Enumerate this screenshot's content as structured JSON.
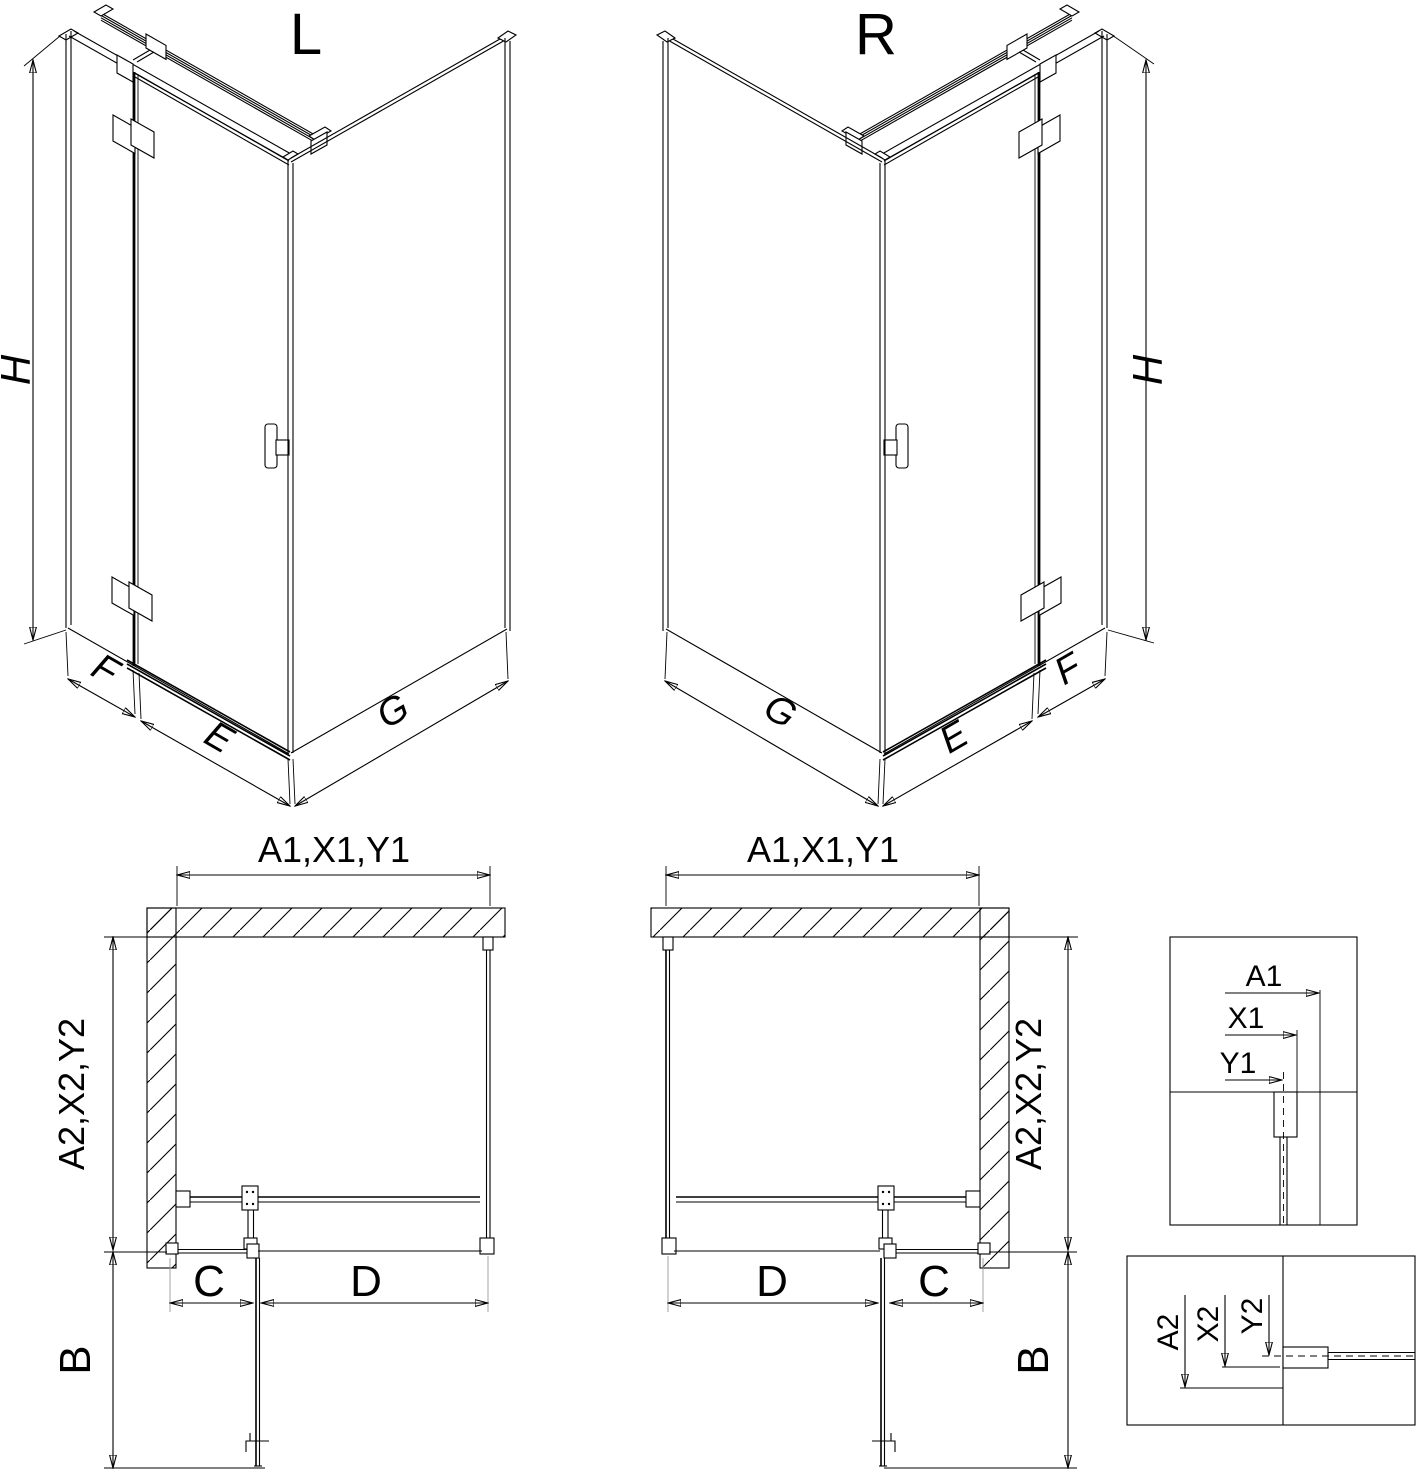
{
  "iso_left": {
    "title": "L",
    "dim_height": "H",
    "dim_side_width": "F",
    "dim_door_width": "E",
    "dim_return_width": "G"
  },
  "iso_right": {
    "title": "R",
    "dim_height": "H",
    "dim_side_width": "F",
    "dim_door_width": "E",
    "dim_return_width": "G"
  },
  "plan_left": {
    "dim_width": "A1,X1,Y1",
    "dim_depth": "A2,X2,Y2",
    "dim_fixed": "C",
    "dim_door": "D",
    "dim_door_open": "B"
  },
  "plan_right": {
    "dim_width": "A1,X1,Y1",
    "dim_depth": "A2,X2,Y2",
    "dim_fixed": "C",
    "dim_door": "D",
    "dim_door_open": "B"
  },
  "detail_width": {
    "dim_outer": "A1",
    "dim_mid": "X1",
    "dim_glass": "Y1"
  },
  "detail_depth": {
    "dim_outer": "A2",
    "dim_mid": "X2",
    "dim_glass": "Y2"
  },
  "colors": {
    "line": "#000000",
    "dim_gray": "#9a9a9a",
    "background": "#ffffff"
  }
}
